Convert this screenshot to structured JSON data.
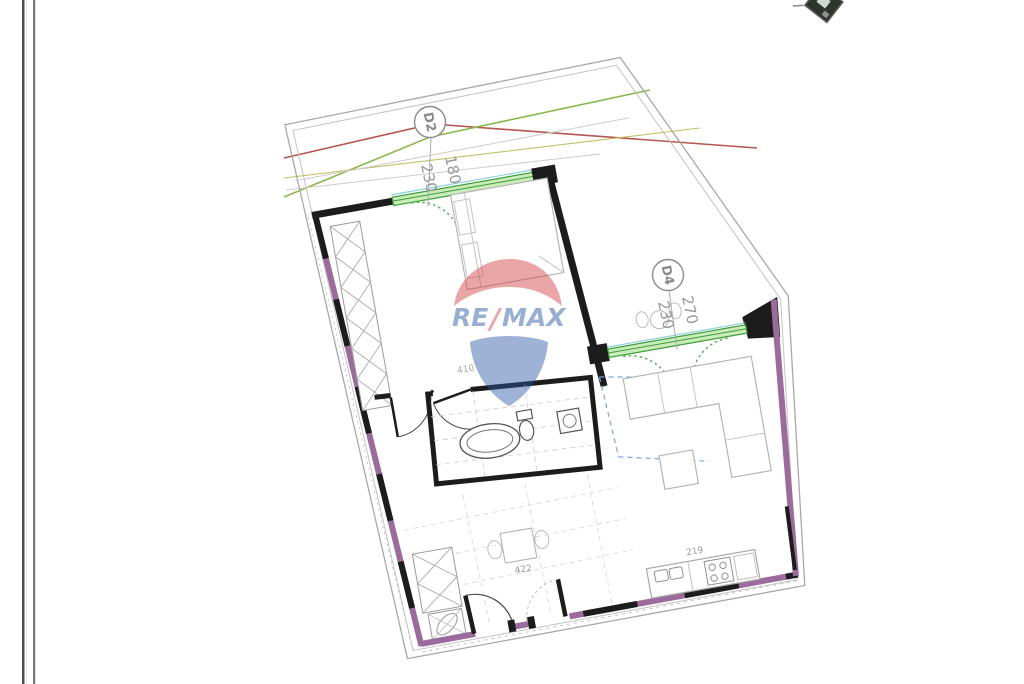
{
  "page": {
    "background": "#ffffff"
  },
  "scan": {
    "left_border_outer": "#4f4f4f",
    "left_border_inner": "#767676"
  },
  "plan": {
    "door_labels": {
      "d2": {
        "id": "D2",
        "width": "180",
        "height": "230"
      },
      "d4": {
        "id": "D4",
        "width": "270",
        "height": "230"
      }
    },
    "dimensions": {
      "bedroom": "410",
      "hallway": "422",
      "kitchen": "219"
    },
    "colors": {
      "wall_purple": "#9b6b9b",
      "wall_black": "#1c1c1c",
      "window_fill": "#c9ecb8",
      "window_border": "#3e9c3e",
      "window_arc_green": "#57b957",
      "roof_line_red": "#b4574f",
      "roof_line_green": "#8ab84e",
      "roof_line_olive": "#c2c06a",
      "blue_dash": "#7aa7d8",
      "boundary_gray": "#a8a8a8",
      "furniture_gray": "#b5b5b5"
    }
  },
  "watermark": {
    "prefix": "RE",
    "slash": "/",
    "suffix": "MAX",
    "red": "#d23a3e",
    "blue": "#2b57a5"
  }
}
